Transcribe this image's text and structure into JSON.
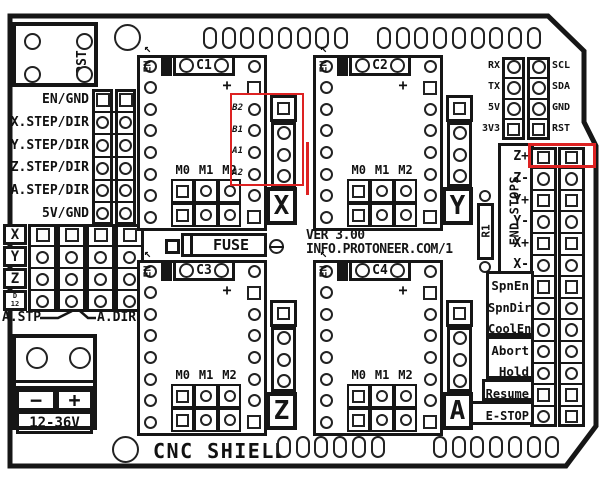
{
  "board": {
    "title": "CNC SHIELD",
    "version_line1": "VER 3.00",
    "version_line2": "INFO.PROTONEER.COM/1",
    "silkscreen_color": "#161616",
    "highlight_color": "#dd2222"
  },
  "reset_button": {
    "label": "RST"
  },
  "solder_pads": {
    "top_counts": [
      8,
      9
    ],
    "bottom_counts": [
      6,
      7
    ]
  },
  "left_header": {
    "labels": [
      "EN/GND",
      "X.STEP/DIR",
      "Y.STEP/DIR",
      "Z.STEP/DIR",
      "A.STEP/DIR",
      "5V/GND"
    ]
  },
  "jumper_block": {
    "row_labels": [
      "X",
      "Y",
      "Z",
      "D12"
    ],
    "right_label": "D13",
    "columns": 4,
    "label_left": "A.STP",
    "label_right": "A.DIR"
  },
  "power_terminal": {
    "minus": "−",
    "plus": "+",
    "voltage": "12-36V"
  },
  "fuse": {
    "label": "FUSE"
  },
  "serial_header": {
    "left_labels": [
      "RX",
      "TX",
      "5V",
      "3V3"
    ],
    "right_labels": [
      "SCL",
      "SDA",
      "GND",
      "RST"
    ]
  },
  "drivers": [
    {
      "id": "C1",
      "axis": "X",
      "enable_label": "EN",
      "plus": "+",
      "mode_labels": [
        "M0",
        "M1",
        "M2"
      ],
      "coil_labels": [
        "B2",
        "B1",
        "A1",
        "A2"
      ]
    },
    {
      "id": "C2",
      "axis": "Y",
      "enable_label": "EN",
      "plus": "+",
      "mode_labels": [
        "M0",
        "M1",
        "M2"
      ],
      "coil_labels": []
    },
    {
      "id": "C3",
      "axis": "Z",
      "enable_label": "EN",
      "plus": "+",
      "mode_labels": [
        "M0",
        "M1",
        "M2"
      ],
      "coil_labels": []
    },
    {
      "id": "C4",
      "axis": "A",
      "enable_label": "EN",
      "plus": "+",
      "mode_labels": [
        "M0",
        "M1",
        "M2"
      ],
      "coil_labels": []
    }
  ],
  "resistor": {
    "label": "R1"
  },
  "endstops": {
    "title": "END STOPS",
    "rows": [
      {
        "label": "Z+",
        "pin": "square"
      },
      {
        "label": "Z-",
        "pin": "circle"
      },
      {
        "label": "Y+",
        "pin": "square"
      },
      {
        "label": "Y-",
        "pin": "circle"
      },
      {
        "label": "X+",
        "pin": "square"
      },
      {
        "label": "X-",
        "pin": "circle"
      }
    ]
  },
  "controls": {
    "groups": [
      {
        "rows": [
          {
            "label": "SpnEn",
            "pin": "square"
          },
          {
            "label": "SpnDir",
            "pin": "circle"
          },
          {
            "label": "CoolEn",
            "pin": "circle"
          }
        ]
      },
      {
        "rows": [
          {
            "label": "Abort",
            "pin": "circle"
          },
          {
            "label": "Hold",
            "pin": "circle"
          }
        ]
      },
      {
        "rows": [
          {
            "label": "Resume",
            "pin": "square"
          }
        ]
      },
      {
        "rows": [
          {
            "label": "E-STOP",
            "pin": "mixed"
          }
        ]
      }
    ]
  }
}
